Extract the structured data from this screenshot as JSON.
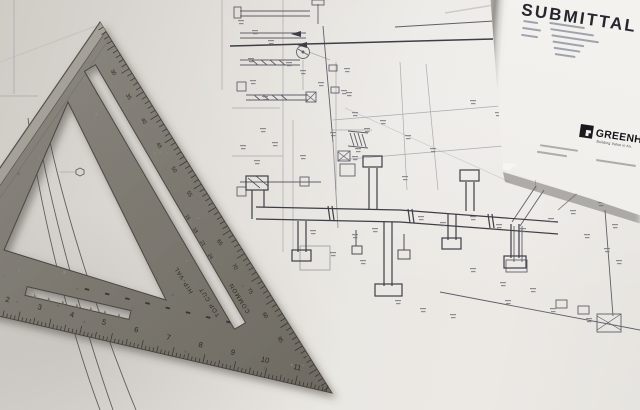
{
  "scene": {
    "type": "photograph",
    "subjects": [
      "metal speed square",
      "HVAC construction blueprint",
      "submittal cover sheet"
    ]
  },
  "submittal_sheet": {
    "title": "SUBMITTAL",
    "brand": "GREENHECK",
    "tagline": "Building Value in Air.",
    "logo_icon": "greenheck-square-icon"
  },
  "speed_square": {
    "inch_numbers": [
      "2",
      "3",
      "4",
      "5",
      "6",
      "7",
      "8",
      "9",
      "10",
      "11"
    ],
    "degree_numbers": [
      "30",
      "35",
      "40",
      "45",
      "50",
      "55",
      "65",
      "70",
      "75",
      "80",
      "85"
    ],
    "rafter_numbers": [
      "15",
      "18",
      "21",
      "24"
    ],
    "scale_labels": {
      "hip_val": "HIP-VAL",
      "top_cut": "TOP CUT",
      "common": "COMMON"
    }
  },
  "colors": {
    "paper": "#dedbd6",
    "sheet_white": "#f2f0ec",
    "metal_gray": "#7d7970",
    "blueprint_ink": "#46464e",
    "title_ink": "#262630"
  }
}
